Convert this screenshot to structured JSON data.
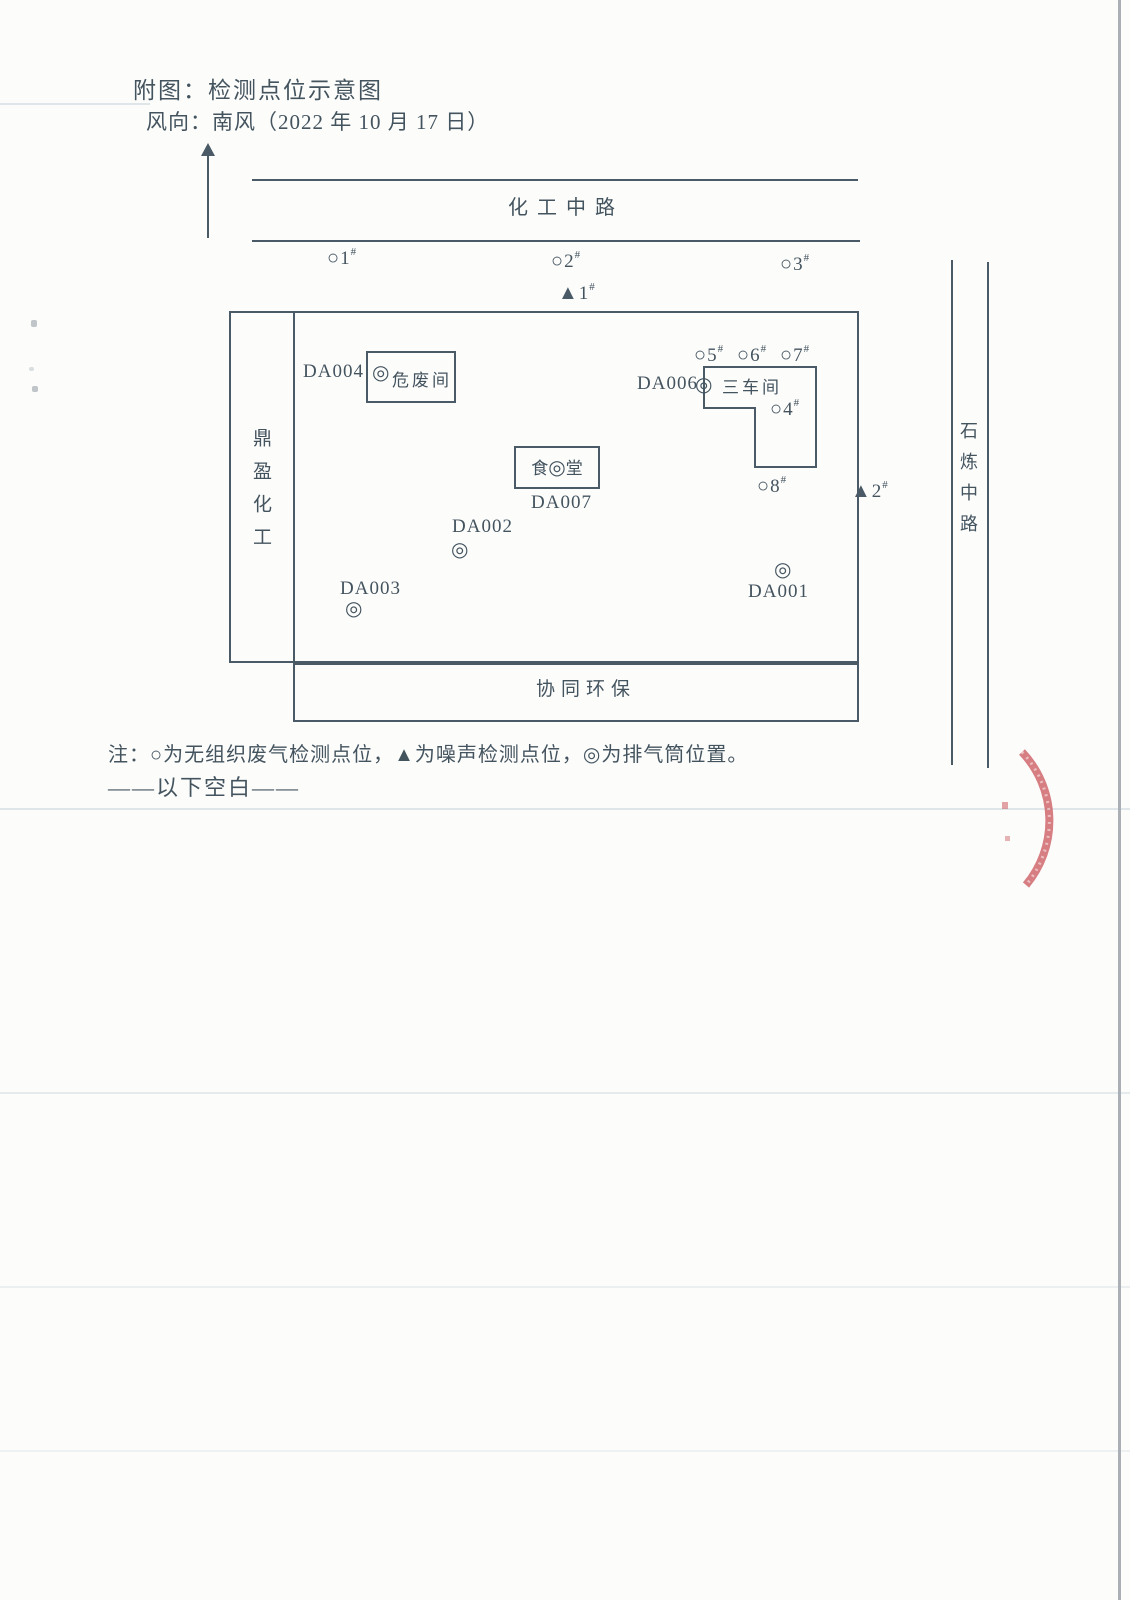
{
  "header": {
    "title": "附图：检测点位示意图",
    "wind": "风向：南风（2022 年 10 月 17 日）"
  },
  "roads": {
    "top": "化工中路",
    "right": "石炼中路"
  },
  "areas": {
    "left_company": "鼎盈化工",
    "bottom_company": "协同环保"
  },
  "buildings": {
    "hazwaste": "危废间",
    "workshop": "三车间",
    "canteen_first": "食",
    "canteen_last": "堂"
  },
  "symbols": {
    "gas": "○",
    "noise": "▲",
    "stack": "◎",
    "hash": "#"
  },
  "points": {
    "gas": [
      "1",
      "2",
      "3",
      "4",
      "5",
      "6",
      "7",
      "8"
    ],
    "noise": [
      "1",
      "2"
    ]
  },
  "stacks": [
    "DA001",
    "DA002",
    "DA003",
    "DA004",
    "DA006",
    "DA007"
  ],
  "footer": {
    "note": "注：○为无组织废气检测点位，▲为噪声检测点位，◎为排气筒位置。",
    "blank": "——以下空白——"
  },
  "colors": {
    "ink": "#4a5a66",
    "stamp": "#cc5a60",
    "paper": "#fcfcfb"
  }
}
